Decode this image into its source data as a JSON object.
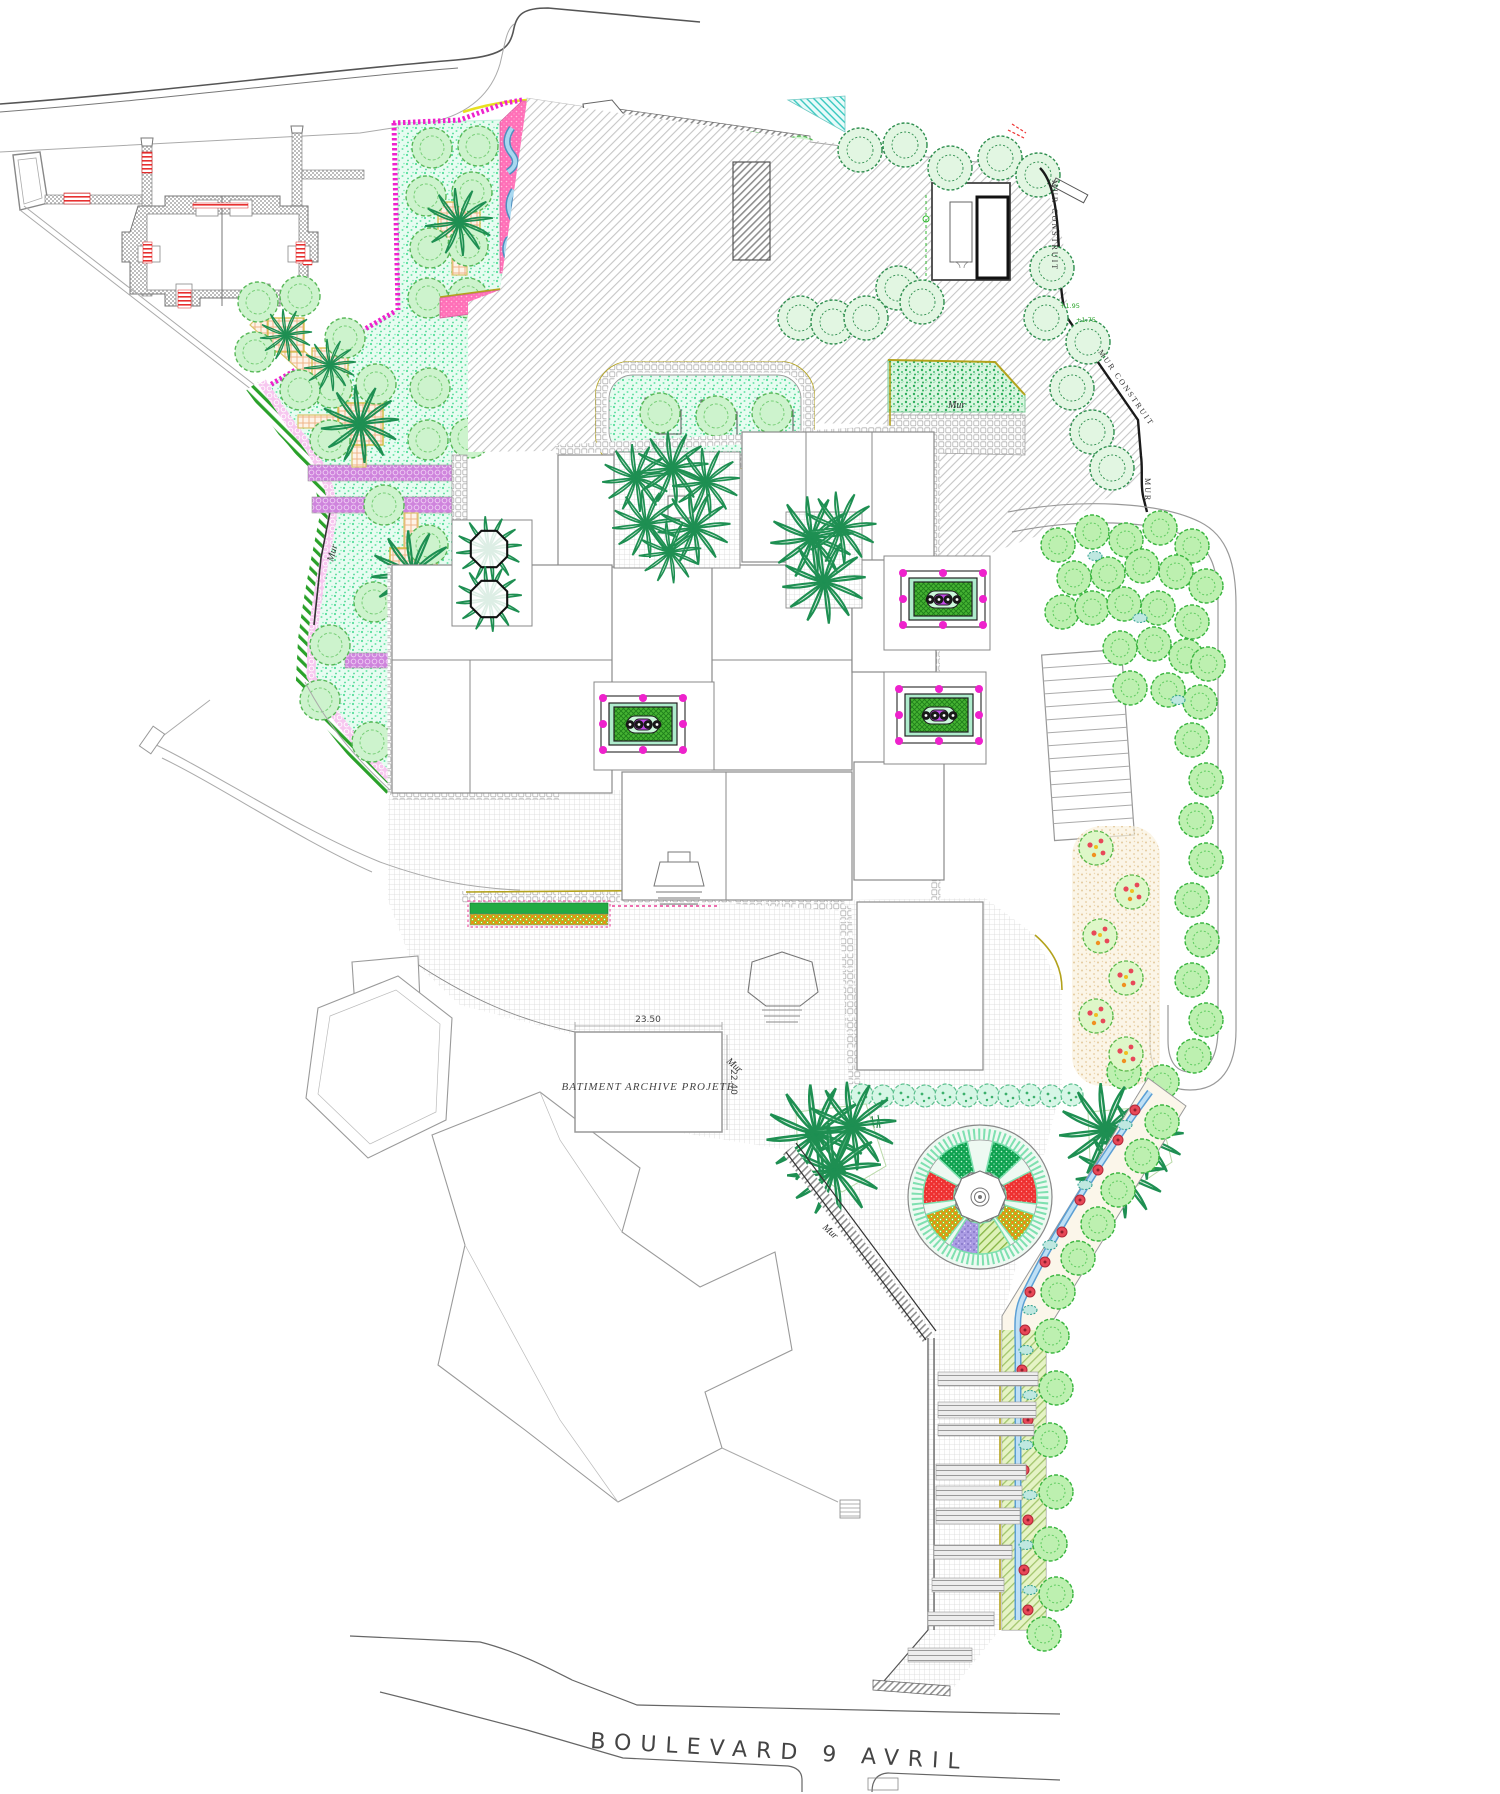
{
  "plan": {
    "street_label": "BOULEVARD 9 AVRIL",
    "building_label": "BATIMENT ARCHIVE PROJETE",
    "dim_width": "23.50",
    "dim_height": "22.40",
    "wall_label": "Mur",
    "built_wall_label": "MUR CONSTRUIT",
    "built_wall_label_short": "MUR",
    "elevation_1": "+1.95",
    "elevation_2": "+1.75",
    "colors": {
      "mint_ground": "#e7fcf1",
      "hot_pink": "#ff70b8",
      "magenta_border": "#ee22cc",
      "dark_green_bed": "#0fa14f",
      "red_bed": "#ee3030",
      "purple_bed": "#ab9ce4",
      "olive_edge": "#b3a21c",
      "stream_blue": "#8ac4ea",
      "tree_green": "#3aa83e",
      "hatch_gray": "#c6c6c6"
    }
  }
}
